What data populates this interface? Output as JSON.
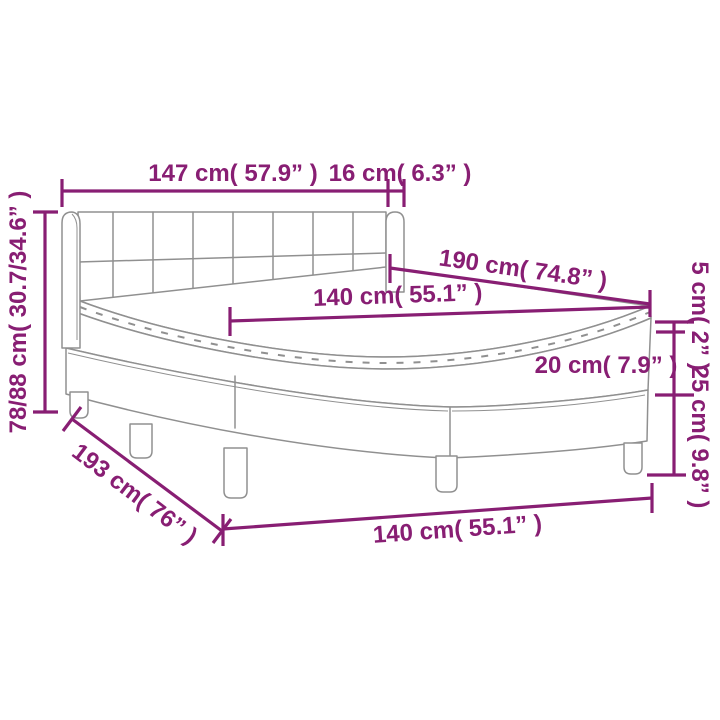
{
  "diagram": {
    "type": "product-dimension-diagram",
    "subject": "box spring bed with tufted headboard, mattress and topper",
    "colors": {
      "dimension": "#881E73",
      "artwork": "#909090",
      "background": "#FFFFFF"
    },
    "labels": {
      "headboard_width": "147 cm( 57.9” )",
      "headboard_wing_depth": "16 cm( 6.3” )",
      "bed_length": "190 cm( 74.8” )",
      "mattress_width": "140 cm( 55.1” )",
      "overall_height_range": "78/88 cm( 30.7/34.6” )",
      "topper_height": "5 cm( 2” )",
      "mattress_height": "20 cm( 7.9” )",
      "base_height": "25 cm( 9.8” )",
      "base_length_floor": "193 cm( 76” )",
      "base_width_floor": "140 cm( 55.1” )"
    }
  }
}
